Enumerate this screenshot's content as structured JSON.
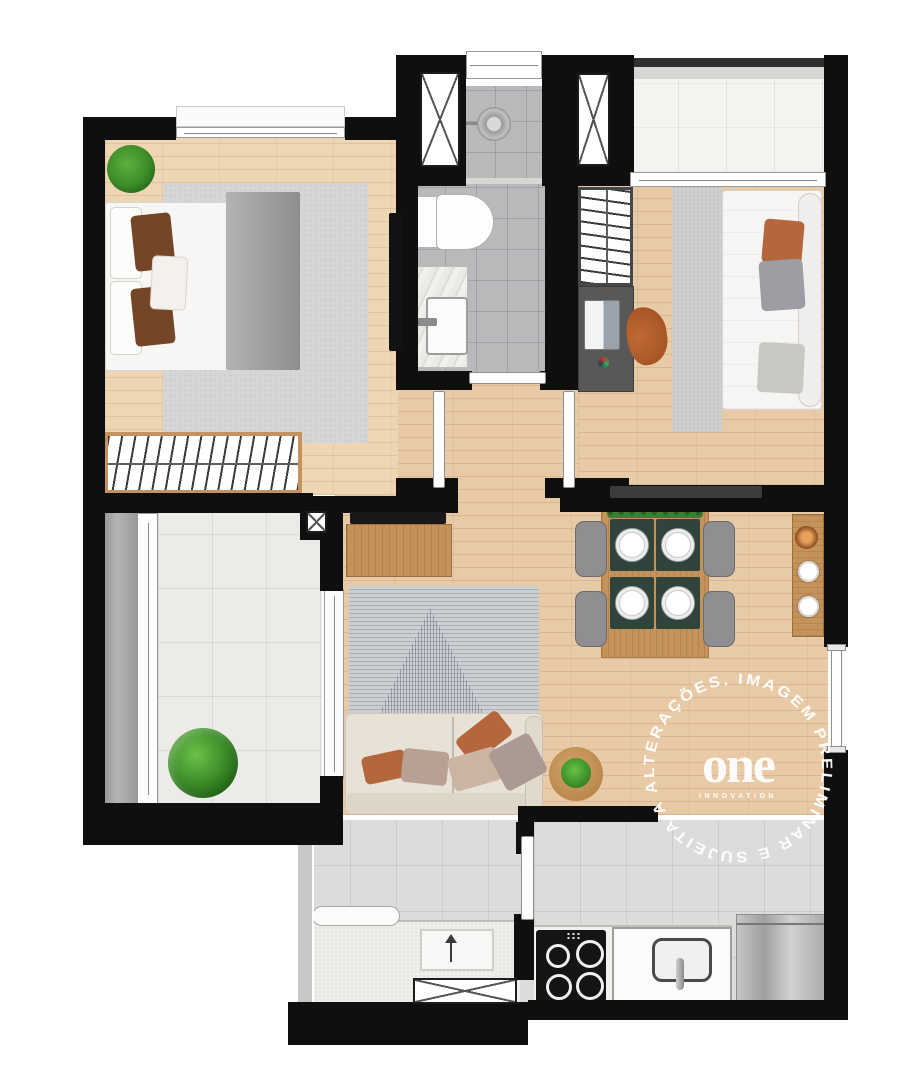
{
  "watermark": {
    "circle_text": "IMAGEM PRELIMINAR E SUJEITA A ALTERAÇÕES.",
    "logo_text": "one",
    "logo_subtext": "INNOVATION"
  },
  "palette": {
    "wall": "#0f0f0f",
    "wood_floor": "#e8cba6",
    "wood_floor_light": "#eed6b4",
    "bathroom_tile": "#b8b9bb",
    "kitchen_tile": "#dcdcda",
    "balcony_tile": "#edebe7",
    "furniture_wood": "#c4935c",
    "rug_gray": "#d6d6d6",
    "accent_terracotta": "#b4663c",
    "placemat_green": "#31443b",
    "plant_green": "#3a8a28",
    "watermark_white": "#ffffff"
  }
}
